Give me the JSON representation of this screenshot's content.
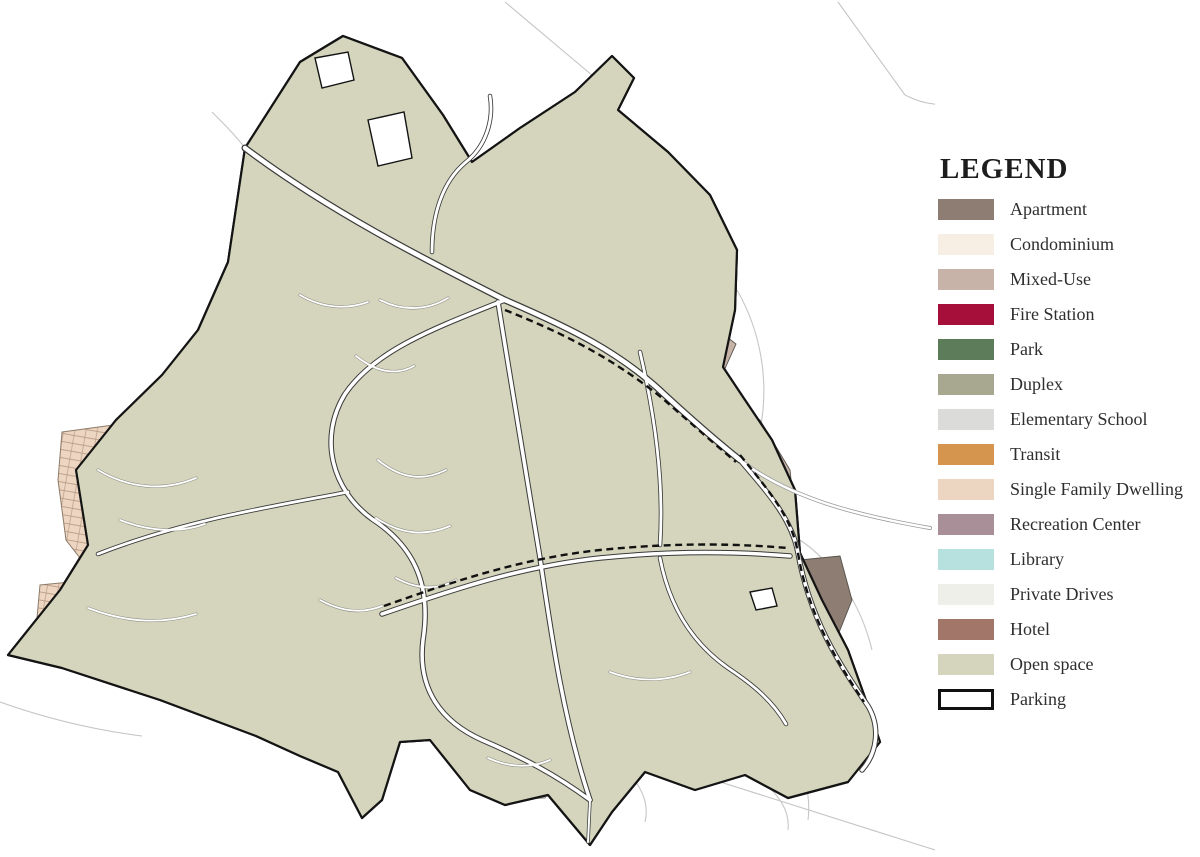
{
  "legend": {
    "title": "LEGEND",
    "items": [
      {
        "id": "apartment",
        "label": "Apartment",
        "color": "#8d7d73"
      },
      {
        "id": "condominium",
        "label": "Condominium",
        "color": "#f7eee4"
      },
      {
        "id": "mixed-use",
        "label": "Mixed-Use",
        "color": "#c8b3a8"
      },
      {
        "id": "fire-station",
        "label": "Fire Station",
        "color": "#a50f3a"
      },
      {
        "id": "park",
        "label": "Park",
        "color": "#5d7c5a"
      },
      {
        "id": "duplex",
        "label": "Duplex",
        "color": "#a8a891"
      },
      {
        "id": "elementary-school",
        "label": "Elementary School",
        "color": "#dbdbd9"
      },
      {
        "id": "transit",
        "label": "Transit",
        "color": "#d6954f"
      },
      {
        "id": "single-family-dwelling",
        "label": "Single Family Dwelling",
        "color": "#ecd5c1"
      },
      {
        "id": "recreation-center",
        "label": "Recreation Center",
        "color": "#a98f98"
      },
      {
        "id": "library",
        "label": "Library",
        "color": "#b7e1de"
      },
      {
        "id": "private-drives",
        "label": "Private Drives",
        "color": "#efefe9"
      },
      {
        "id": "hotel",
        "label": "Hotel",
        "color": "#a3766a"
      },
      {
        "id": "open-space",
        "label": "Open space",
        "color": "#d4d5bc"
      },
      {
        "id": "parking",
        "label": "Parking",
        "color": "#ffffff",
        "border": "#111111"
      }
    ]
  },
  "map": {
    "background": "#ffffff",
    "boundary_color": "#141414",
    "parcel_line_color": "#55514a",
    "road_casing_color": "#3a3a3a",
    "road_fill_color": "#ffffff",
    "context_line_color": "#c6c6c6",
    "mixed_use_north_color": "#c2a56f0"
  }
}
